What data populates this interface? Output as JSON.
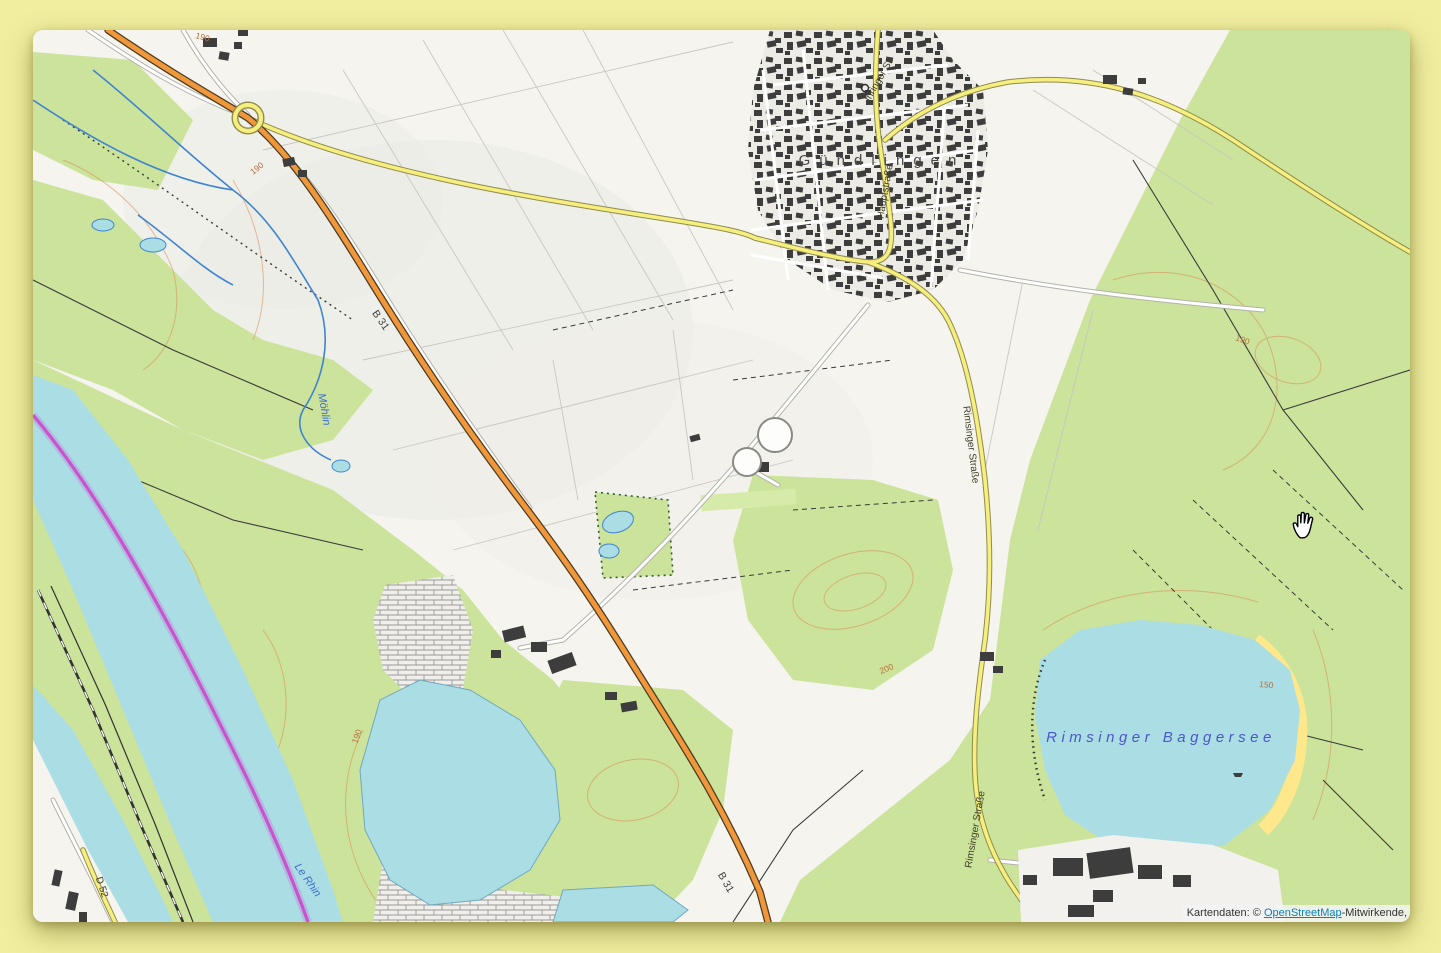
{
  "window": {
    "type": "topographic-map-viewer"
  },
  "colors": {
    "page_background": "#f1ee9f",
    "land": "#f5f4ef",
    "forest": "#cbe39b",
    "water": "#abdde4",
    "water_label": "#4a58c8",
    "stream": "#3f84cf",
    "road_primary_orange": "#f0973b",
    "road_secondary_yellow": "#f6ee7d",
    "road_minor_white": "#ffffff",
    "national_boundary_magenta": "#cc3fcc",
    "contour_orange": "#d9935e",
    "building_gray": "#3d3d3d",
    "beach_yellow": "#ffe88c",
    "attribution_link_blue": "#0a7fbe"
  },
  "map": {
    "town_label": "Gündlingen",
    "lake_label": "Rimsinger Baggersee",
    "streets": {
      "hauptstrasse": "Hauptstraße",
      "ihringer": "Ihringer St",
      "rimsinger_north": "Rimsinger Straße",
      "rimsinger_south": "Rimsinger Straße",
      "d52": "D 52"
    },
    "road_refs": {
      "b31_north": "B 31",
      "b31_south": "B 31"
    },
    "waters": {
      "rhine": "Le Rhin",
      "moehlin": "Möhlin"
    },
    "contours": [
      "190",
      "190",
      "190",
      "200",
      "190",
      "150"
    ]
  },
  "cursor": {
    "icon": "open-hand"
  },
  "attribution": {
    "prefix": "Kartendaten: © ",
    "link": "OpenStreetMap",
    "suffix": "-Mitwirkende,"
  }
}
